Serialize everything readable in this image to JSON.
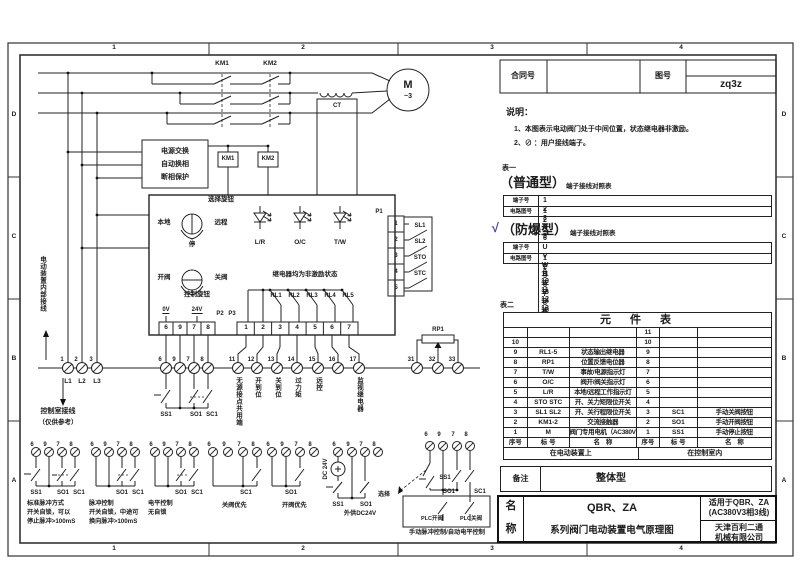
{
  "frame": {
    "top": [
      "1",
      "2",
      "3",
      "4"
    ],
    "bottom": [
      "1",
      "2",
      "3",
      "4"
    ],
    "left": [
      "D",
      "C",
      "B",
      "A"
    ],
    "right": [
      "D",
      "C",
      "B",
      "A"
    ]
  },
  "title_block": {
    "contract_label": "合同号",
    "drawing_label": "图号",
    "drawing_no": "zq3z"
  },
  "notes": {
    "heading": "说明：",
    "item1": "1、本图表示电动阀门处于中间位置，状态继电器非激励。",
    "item2": "2、⊘ ：用户接线端子。"
  },
  "table1": {
    "caption": "表一",
    "normal": {
      "name": "（普通型）",
      "suffix": "端子接线对照表",
      "row1_label": "端子号",
      "row2_label": "电路图号",
      "row1": [
        "1",
        "2",
        "3",
        "4",
        "5",
        "6",
        "7",
        "8",
        "9",
        "10",
        "11",
        "12",
        "13",
        "14",
        "15",
        "16",
        "17",
        "18"
      ],
      "row2": [
        "1",
        "2",
        "3",
        "",
        "6",
        "7",
        "8",
        "9",
        "11",
        "12",
        "13",
        "14",
        "15",
        "16",
        "17",
        "31",
        "32",
        "33"
      ]
    },
    "explosion": {
      "check": "√",
      "name": "（防爆型）",
      "suffix": "端子接线对照表",
      "row1_label": "端子号",
      "row2_label": "电路图号",
      "row1": [
        "U",
        "V",
        "W",
        "E",
        "1",
        "2",
        "3",
        "4",
        "5",
        "6",
        "7",
        "8",
        "9",
        "10",
        "11",
        "12",
        "13",
        "14"
      ],
      "row2": [
        "1",
        "2",
        "3",
        "",
        "6",
        "7",
        "8",
        "9",
        "11",
        "12",
        "13",
        "14",
        "15",
        "16",
        "17",
        "31",
        "32",
        "33"
      ]
    }
  },
  "table2": {
    "caption": "表二",
    "title": "元　件　表",
    "rows": [
      [
        "",
        "",
        "",
        "11",
        "",
        ""
      ],
      [
        "10",
        "",
        "",
        "10",
        "",
        ""
      ],
      [
        "9",
        "RL1-5",
        "状态输出继电器",
        "9",
        "",
        ""
      ],
      [
        "8",
        "RP1",
        "位置反馈电位器",
        "8",
        "",
        ""
      ],
      [
        "7",
        "T/W",
        "事故/电源指示灯",
        "7",
        "",
        ""
      ],
      [
        "6",
        "O/C",
        "阀开/阀关指示灯",
        "6",
        "",
        ""
      ],
      [
        "5",
        "L/R",
        "本地/远程工作指示灯",
        "5",
        "",
        ""
      ],
      [
        "4",
        "STO STC",
        "开、关力矩限位开关",
        "4",
        "",
        ""
      ],
      [
        "3",
        "SL1 SL2",
        "开、关行程限位开关",
        "3",
        "SC1",
        "手动关阀按钮"
      ],
      [
        "2",
        "KM1-2",
        "交流接触器",
        "2",
        "SO1",
        "手动开阀按钮"
      ],
      [
        "1",
        "M",
        "阀门专用电机（AC380V）",
        "1",
        "SS1",
        "手动停止按钮"
      ]
    ],
    "header": [
      "序号",
      "标 号",
      "名　称",
      "序号",
      "标 号",
      "名　称"
    ],
    "footer": [
      "在电动装置上",
      "在控制室内"
    ]
  },
  "remarks": {
    "label": "备注",
    "value": "整体型"
  },
  "name_block": {
    "label_top": "名",
    "label_bottom": "称",
    "model": "QBR、ZA",
    "product": "系列阀门电动装置电气原理图",
    "scope1": "适用于QBR、ZA",
    "scope2": "(AC380V3相3线)",
    "company1": "天津百利二通",
    "company2": "机械有限公司"
  },
  "sch": {
    "km1": "KM1",
    "km2": "KM2",
    "ct": "CT",
    "m": "M",
    "m3": "~3",
    "pw1": "电源交换",
    "pw2": "自动换相",
    "pw3": "断相保护",
    "kc1": "KM1",
    "kc2": "KM2",
    "sel": "选择旋钮",
    "local": "本地",
    "remote": "远程",
    "stop": "停",
    "led1": "L/R",
    "led2": "O/C",
    "led3": "T/W",
    "open": "开阀",
    "close": "关阀",
    "ctrl": "控制旋钮",
    "relay_note": "继电器均为非激励状态",
    "rl1": "RL1",
    "rl2": "RL2",
    "rl3": "RL3",
    "rl4": "RL4",
    "rl5": "RL5",
    "v0": "0V",
    "v24": "24V",
    "p1": "P1",
    "p2": "P2",
    "p3": "P3",
    "p2c": [
      "6",
      "9",
      "7",
      "8"
    ],
    "p3c": [
      "1",
      "2",
      "3",
      "4",
      "5",
      "6",
      "7"
    ],
    "p1c": [
      "1",
      "2",
      "3",
      "4",
      "5"
    ],
    "sl1": "SL1",
    "sl2": "SL2",
    "sto": "STO",
    "stc": "STC",
    "n1": "1",
    "n2": "2",
    "n3": "3",
    "n6": "6",
    "n9": "9",
    "n7": "7",
    "n8": "8",
    "n11": "11",
    "n12": "12",
    "n13": "13",
    "n14": "14",
    "n15": "15",
    "n16": "16",
    "n17": "17",
    "n31": "31",
    "n32": "32",
    "n33": "33",
    "l1": "L1",
    "l2": "L2",
    "l3": "L3",
    "inner_side": "电动装置内部接线",
    "room_side": "控制室接线",
    "room_note": "（仅供参考）",
    "ss1": "SS1",
    "so1": "SO1",
    "sc1": "SC1",
    "vt11": "无源接点共用端",
    "vt12": "开到位",
    "vt13": "关到位",
    "vt14": "过力矩",
    "vt15": "远控",
    "vt17": "监视继电器",
    "rp1": "RP1"
  },
  "schemes": [
    {
      "ss1": "SS1",
      "so1": "SO1",
      "sc1": "SC1",
      "d1": "标准脉冲方式",
      "d2": "开关自锁，可以",
      "d3": "停止脉冲>100mS"
    },
    {
      "so1": "SO1",
      "sc1": "SC1",
      "d1": "脉冲控制",
      "d2": "开关自锁，中途可",
      "d3": "换向脉冲>100mS"
    },
    {
      "so1": "SO1",
      "sc1": "SC1",
      "d1": "电平控制",
      "d2": "无自锁"
    },
    {
      "sc1": "SC1",
      "d1": "关阀优先"
    },
    {
      "so1": "SO1",
      "d1": "开阀优先"
    },
    {
      "src": "DC 24V",
      "ss1": "SS1",
      "so1": "SO1",
      "d1": "外供DC24V"
    },
    {
      "select": "选择",
      "ss1": "SS1",
      "so1": "SO1",
      "sc1": "SC1",
      "plc_open": "PLC开阀",
      "plc_close": "PLC关阀",
      "d1": "手动脉冲控制/自动电平控制"
    }
  ],
  "colors": {
    "ink": "#1c1c1c",
    "check_blue": "#3f3fae",
    "paper": "#ffffff"
  }
}
